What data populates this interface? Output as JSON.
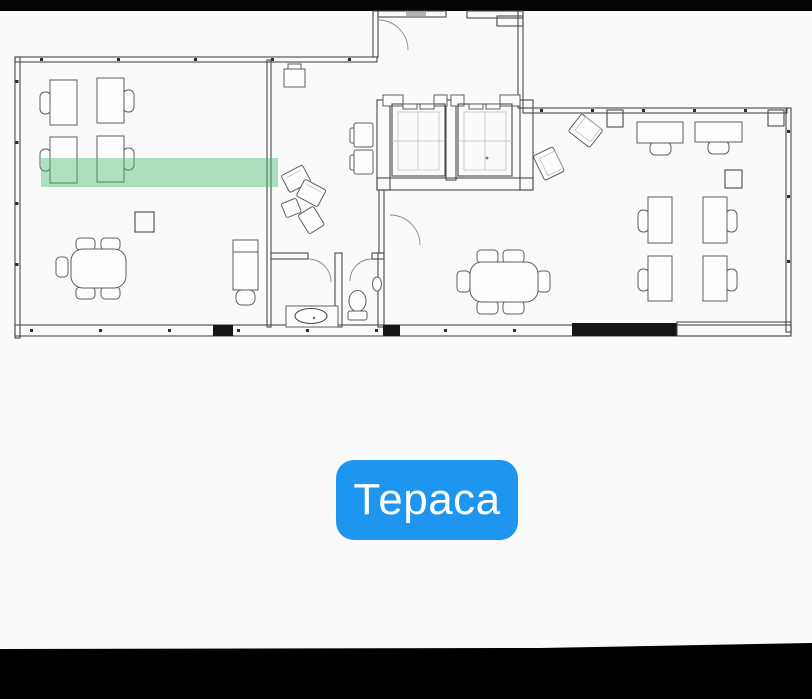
{
  "label": {
    "text": "Тераса"
  },
  "colors": {
    "accent_blue": "#1e96f0",
    "label_text": "#ffffff",
    "highlight_green": "#3fbd6d",
    "plan_line": "#4a4a4a",
    "crop_black": "#000000"
  },
  "floor_plan": {
    "type": "architectural-floor-plan",
    "highlighted_zone": "green strip across the left office",
    "rooms": [
      "left-office",
      "corridor-lobby",
      "elevator-bank",
      "wc",
      "right-office"
    ],
    "furniture": {
      "left_office": [
        "4 desks with chairs",
        "meeting table with 5 chairs",
        "plant",
        "lounge chair"
      ],
      "corridor_lobby": [
        "reception chair",
        "2 waiting chairs",
        "fan seating group"
      ],
      "elevator_bank": [
        "2 elevator cars"
      ],
      "wc": [
        "sink counter",
        "toilet",
        "wall basin"
      ],
      "right_office": [
        "2 tilted armchairs",
        "2 wide desks with chairs",
        "4 desks with chairs",
        "meeting table with 6 chairs",
        "plant"
      ]
    }
  }
}
